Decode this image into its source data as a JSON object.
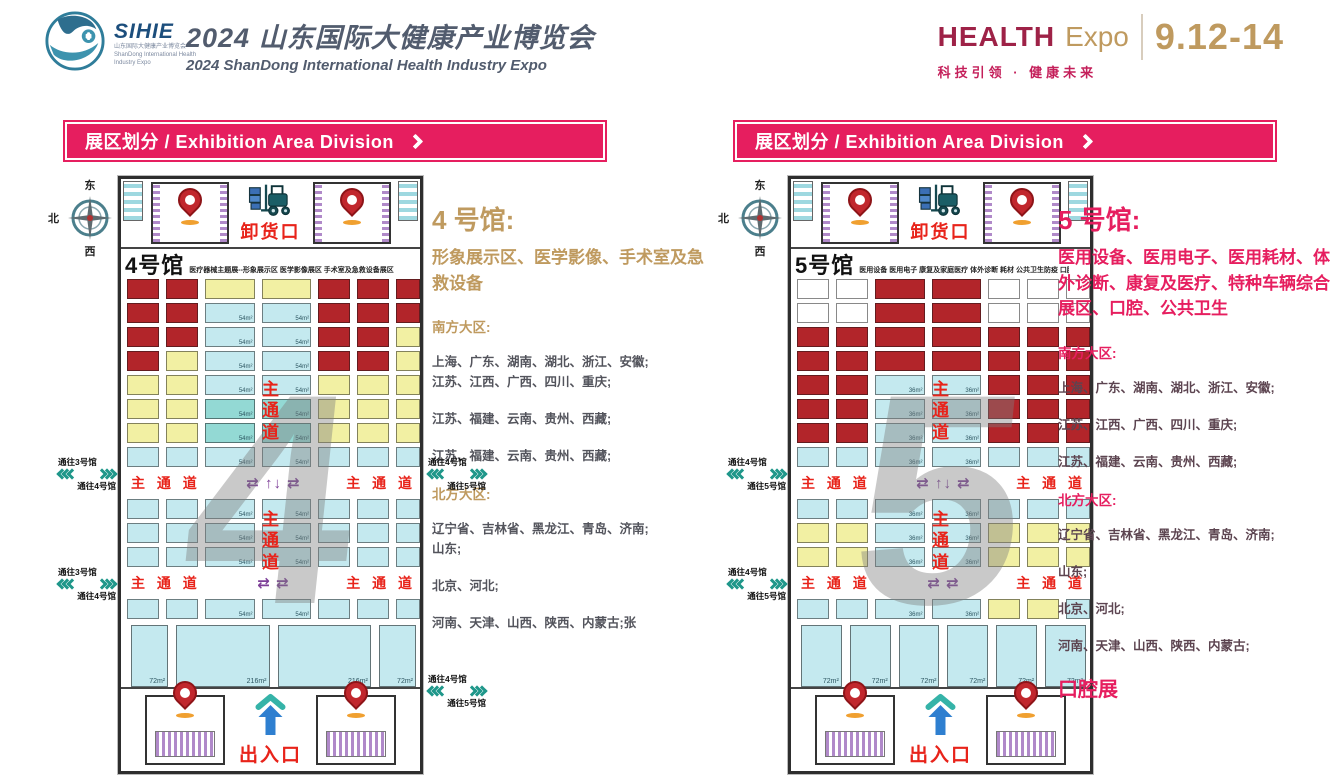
{
  "header": {
    "logo_name": "SIHIE",
    "logo_sub_cn": "山东国际大健康产业博览会",
    "logo_sub_en": "ShanDong International Health Industry Expo",
    "title_cn": "2024 山东国际大健康产业博览会",
    "title_en": "2024 ShanDong International Health Industry Expo",
    "brand_health": "HEALTH",
    "brand_expo": "Expo",
    "dates": "9.12-14",
    "slogan": "科技引领 · 健康未来"
  },
  "section_bar": {
    "label": "展区划分 / Exhibition Area Division"
  },
  "compass": {
    "n": "北",
    "e": "东",
    "s": "南",
    "w": "西"
  },
  "colors": {
    "accent_pink": "#e61e5f",
    "accent_gold": "#bf9a5f",
    "aisle_red": "#e8231a",
    "chevron_teal": "#1f978a",
    "booth_red": "#b2252a",
    "booth_cyan": "#c4e9ef",
    "booth_teal": "#93d9d4",
    "booth_yellow": "#f2f0a3",
    "booth_white": "#ffffff"
  },
  "halls": [
    {
      "name": "4号馆",
      "categories": "医疗器械主题展--形象展示区 医学影像展区 手术室及急救设备展区",
      "dock_label": "卸货口",
      "exit_label": "出入口",
      "watermark": "4",
      "aisle_label": "主 通 道",
      "aisle_vertical": "主通道",
      "cell_area": "54m²",
      "rows": [
        "RRYYRRR",
        "RRCCRRR",
        "RRCCRRY",
        "RYCCRRY",
        "YYCCYYY",
        "YYTTYYY",
        "YYTTYYY",
        "CCCCCCC",
        "AISLE1",
        "CCCCCCC",
        "CCCCCCC",
        "CCCCCCC",
        "AISLE2",
        "CCCCCCC"
      ],
      "aisle1_arrows": "⇄ ↑↓ ⇄",
      "aisle2_arrows": "⇄  ⇄",
      "corridors": [
        {
          "slot": "left_top",
          "to_top": "通往3号馆",
          "to_bottom": "通往4号馆"
        },
        {
          "slot": "left_mid",
          "to_top": "通往3号馆",
          "to_bottom": "通往4号馆"
        },
        {
          "slot": "right_top",
          "to_top": "通往4号馆",
          "to_bottom": "通往5号馆"
        },
        {
          "slot": "right_bottom",
          "to_top": "通往4号馆",
          "to_bottom": "通往5号馆"
        }
      ],
      "bottom_booths": [
        {
          "area": "72m²",
          "w": 1
        },
        {
          "area": "216m²",
          "w": 2.6
        },
        {
          "area": "216m²",
          "w": 2.6
        },
        {
          "area": "72m²",
          "w": 1
        }
      ]
    },
    {
      "name": "5号馆",
      "categories": "医用设备 医用电子 康复及家庭医疗 体外诊断 耗材 公共卫生防疫 口腔展",
      "dock_label": "卸货口",
      "exit_label": "出入口",
      "watermark": "5",
      "aisle_label": "主 通 道",
      "aisle_vertical": "主通道",
      "cell_area": "36m²",
      "rows": [
        "WWRRWWW",
        "WWRRWWW",
        "RRRRRRR",
        "RRRRRRR",
        "RRCCRRR",
        "RRCCRRR",
        "RRCCRRR",
        "CCCCCCC",
        "AISLE1",
        "CCCCCCC",
        "YYCCYYY",
        "YYCCYYY",
        "AISLE2",
        "CCCCYYC"
      ],
      "aisle1_arrows": "⇄ ↑↓ ⇄",
      "aisle2_arrows": "⇄  ⇄",
      "corridors": [
        {
          "slot": "left_top",
          "to_top": "通往4号馆",
          "to_bottom": "通往5号馆"
        },
        {
          "slot": "left_mid",
          "to_top": "通往4号馆",
          "to_bottom": "通往5号馆"
        }
      ],
      "bottom_booths": [
        {
          "area": "72m²",
          "w": 1
        },
        {
          "area": "72m²",
          "w": 1
        },
        {
          "area": "72m²",
          "w": 1
        },
        {
          "area": "72m²",
          "w": 1
        },
        {
          "area": "72m²",
          "w": 1
        },
        {
          "area": "72m²",
          "w": 1
        }
      ]
    }
  ],
  "descriptions": [
    {
      "accent": "#bf9a5f",
      "body_color": "#53545c",
      "title": "4 号馆:",
      "subtitle": "形象展示区、医学影像、手术室及急救设备",
      "south_label": "南方大区:",
      "south": [
        [
          "上海、广东、湖南、湖北、浙江、安徽;",
          "江苏、江西、广西、四川、重庆;"
        ],
        [
          "江苏、福建、云南、贵州、西藏;"
        ],
        [
          "江苏、福建、云南、贵州、西藏;"
        ]
      ],
      "north_label": "北方大区:",
      "north": [
        [
          "辽宁省、吉林省、黑龙江、青岛、济南;",
          "山东;"
        ],
        [
          "北京、河北;"
        ],
        [
          "河南、天津、山西、陕西、内蒙古;张"
        ]
      ],
      "extra": ""
    },
    {
      "accent": "#e61e5f",
      "body_color": "#5c4450",
      "title": "5 号馆:",
      "subtitle": "医用设备、医用电子、医用耗材、体外诊断、康复及医疗、特种车辆综合展区、口腔、公共卫生",
      "south_label": "南方大区:",
      "south": [
        [
          "上海、广东、湖南、湖北、浙江、安徽;"
        ],
        [
          "江苏、江西、广西、四川、重庆;"
        ],
        [
          "江苏、福建、云南、贵州、西藏;"
        ]
      ],
      "north_label": "北方大区:",
      "north": [
        [
          "辽宁省、吉林省、黑龙江、青岛、济南;"
        ],
        [
          "山东;"
        ],
        [
          "北京、河北;"
        ],
        [
          "河南、天津、山西、陕西、内蒙古;"
        ]
      ],
      "extra": "口腔展"
    }
  ]
}
